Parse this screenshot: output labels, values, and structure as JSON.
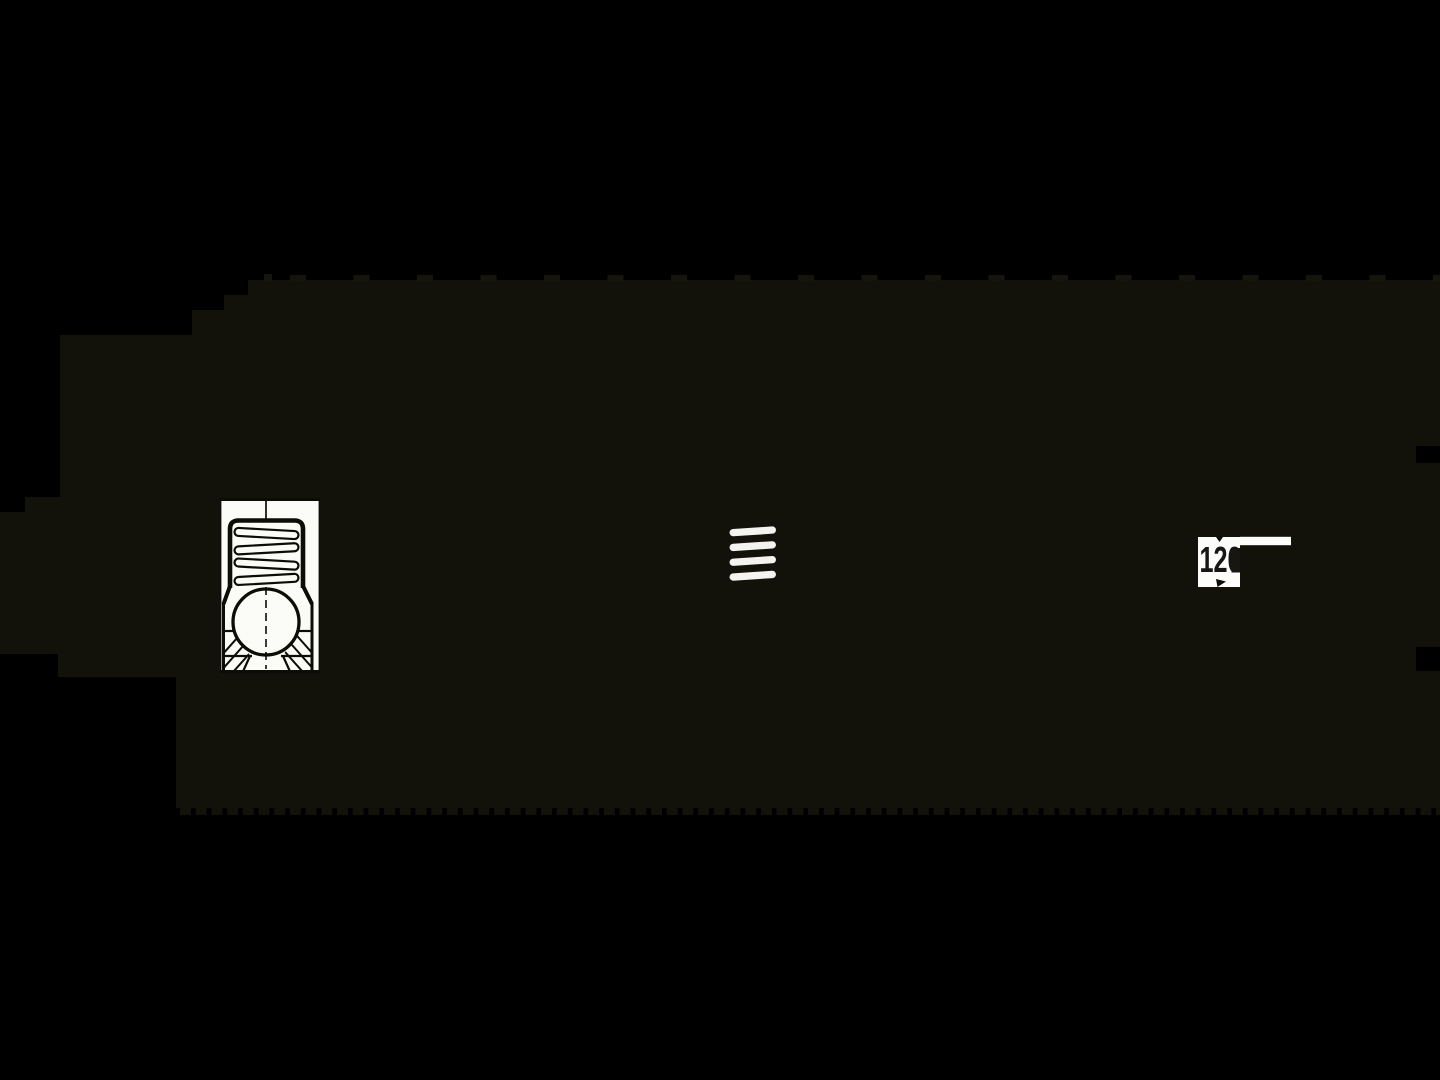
{
  "canvas": {
    "width": 1440,
    "height": 1080,
    "background_color": "#000000"
  },
  "blob": {
    "color": "#12120a",
    "edge_tooth_color": "#15150d",
    "top_edge_y": 280,
    "bottom_edge_y": 808,
    "top_teeth": {
      "start_x": 290,
      "pitch": 63.5,
      "width": 16,
      "height": 6
    },
    "bottom_teeth": {
      "start_x": 180,
      "pitch": 15.7,
      "width": 11,
      "height": 8
    }
  },
  "cross_section_drawing": {
    "description": "spring-plunger cross section with zigzag spring and ball",
    "paper_color": "#fbfbf8",
    "line_color": "#0d0d07",
    "coil_turns": 4
  },
  "coil_side_view": {
    "bar_color": "#f3f3ef",
    "bar_count": 4
  },
  "dimension_label": {
    "text": "120",
    "text_color": "#161616",
    "halo_color": "#fcfcfa",
    "overlay_color": "#17170f"
  }
}
